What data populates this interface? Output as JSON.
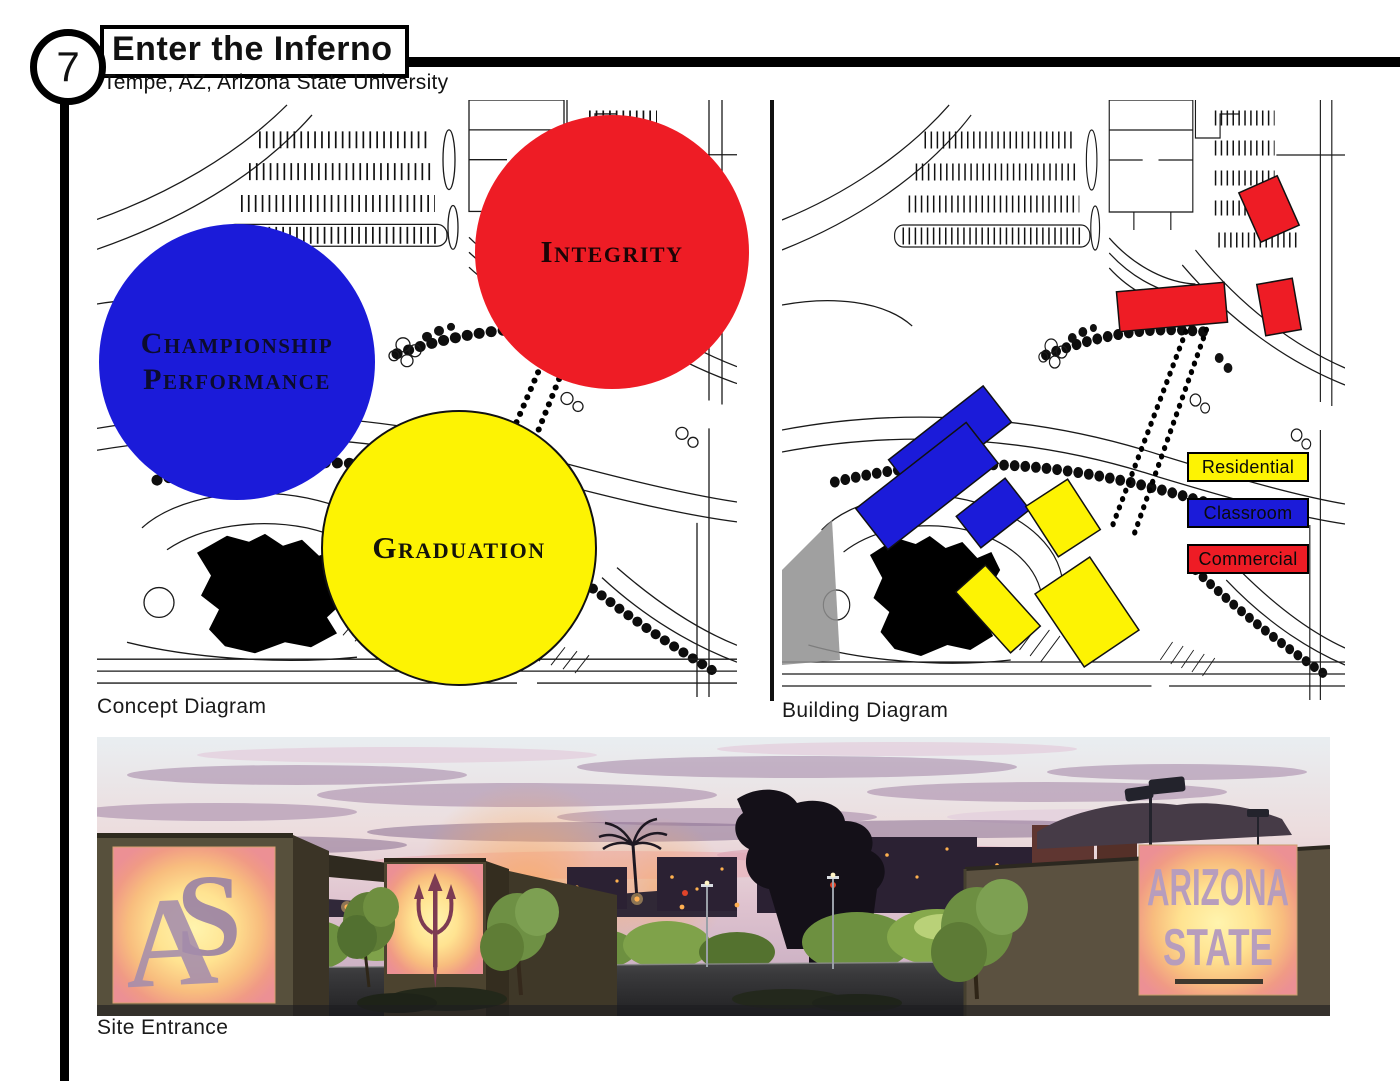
{
  "page": {
    "number": "7",
    "title": "Enter the Inferno",
    "subtitle": "Tempe, AZ, Arizona State University"
  },
  "colors": {
    "red": "#ee1c25",
    "blue": "#1b1bd9",
    "yellow": "#fdf303",
    "map_line": "#000000"
  },
  "concept_diagram": {
    "caption": "Concept Diagram",
    "circles": [
      {
        "name": "championship-performance",
        "label_lines": [
          "Championship",
          "Performance"
        ],
        "color": "#1b1bd9"
      },
      {
        "name": "integrity",
        "label_lines": [
          "Integrity"
        ],
        "color": "#ee1c25"
      },
      {
        "name": "graduation",
        "label_lines": [
          "Graduation"
        ],
        "color": "#fdf303"
      }
    ]
  },
  "building_diagram": {
    "caption": "Building Diagram",
    "legend": [
      {
        "label": "Residential",
        "color": "#fdf303"
      },
      {
        "label": "Classroom",
        "color": "#1b1bd9"
      },
      {
        "label": "Commercial",
        "color": "#ee1c25"
      }
    ]
  },
  "site_entrance": {
    "caption": "Site Entrance",
    "monogram_letters": [
      "A",
      "S"
    ],
    "sign_lines": [
      "ARIZONA",
      "STATE"
    ]
  }
}
